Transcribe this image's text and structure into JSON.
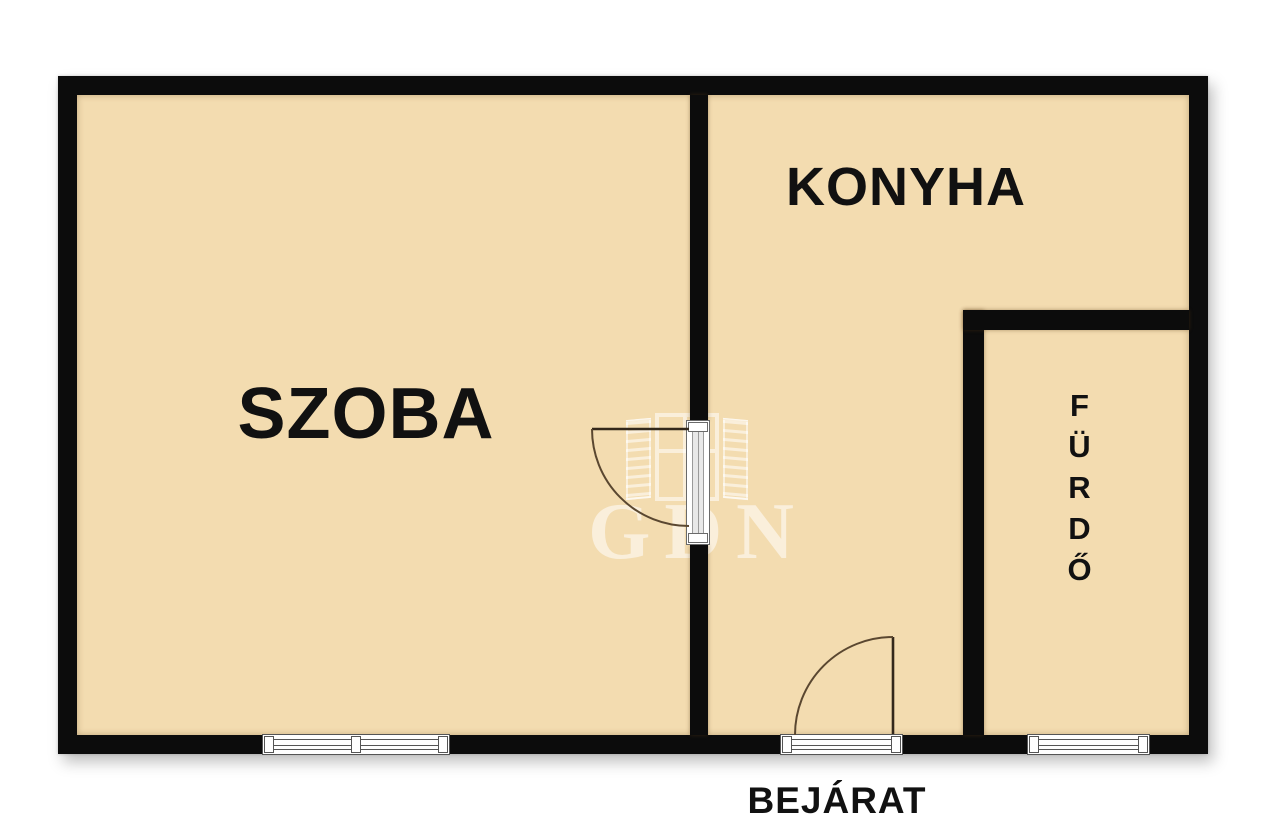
{
  "rooms": {
    "szoba": {
      "label": "SZOBA"
    },
    "konyha": {
      "label": "KONYHA"
    },
    "furdo": {
      "label": "FÜRDŐ"
    }
  },
  "entrance": {
    "label": "BEJÁRAT"
  },
  "watermark": {
    "text": "GDN",
    "icon": "open-window-icon"
  },
  "colors": {
    "wall": "#0c0c0c",
    "floor": "#f3dcb0",
    "label": "#111111",
    "door_swing": "#5a4730",
    "door_leaf": "#33281b",
    "frame_line": "#555555",
    "background": "#ffffff",
    "watermark": "rgba(255,255,255,0.55)"
  }
}
